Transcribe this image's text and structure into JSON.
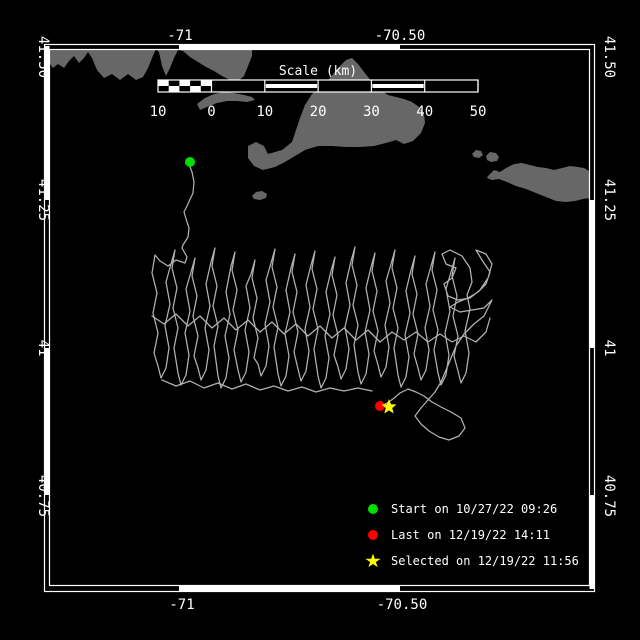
{
  "colors": {
    "background": "#000000",
    "frame": "#ffffff",
    "land": "#676767",
    "track": "#b2b2b2",
    "start": "#00e000",
    "last": "#ff0000",
    "selected": "#ffff00"
  },
  "axes": {
    "x_ticks": [
      {
        "label": "-71",
        "px": 180
      },
      {
        "label": "-70.50",
        "px": 400
      }
    ],
    "y_ticks": [
      {
        "label": "41.50",
        "py": 57
      },
      {
        "label": "41.25",
        "py": 200
      },
      {
        "label": "41",
        "py": 348
      },
      {
        "label": "40.75",
        "py": 496
      }
    ],
    "top_label_y": 40,
    "bottom_label_y": 609,
    "left_label_x": 39,
    "right_label_x": 605
  },
  "frame": {
    "outer": [
      44.5,
      44.5,
      594.5,
      591.5
    ],
    "inner": [
      49.5,
      49.5,
      589.5,
      585.5
    ],
    "solid_segments": {
      "top": [
        [
          179,
          400
        ]
      ],
      "bottom": [
        [
          179,
          400
        ]
      ],
      "left": [
        [
          46,
          200
        ],
        [
          348,
          495
        ]
      ],
      "right": [
        [
          200,
          348
        ],
        [
          495,
          589
        ]
      ]
    }
  },
  "scalebar": {
    "title": "Scale (km)",
    "title_px": 318,
    "title_py": 75,
    "x0": 158,
    "x1": 478,
    "y0": 80,
    "y1": 92,
    "zero_px": 211.5,
    "label_y": 116,
    "ticks": [
      {
        "label": "10",
        "px": 158
      },
      {
        "label": "0",
        "px": 211.5
      },
      {
        "label": "10",
        "px": 264.8
      },
      {
        "label": "20",
        "px": 318.1
      },
      {
        "label": "30",
        "px": 371.4
      },
      {
        "label": "40",
        "px": 424.7
      },
      {
        "label": "50",
        "px": 478
      }
    ],
    "striped_cells": [
      1,
      3
    ]
  },
  "legend": {
    "items": [
      {
        "marker": "circle",
        "color": "#00e000",
        "label": "Start on 10/27/22 09:26"
      },
      {
        "marker": "circle",
        "color": "#ff0000",
        "label": "Last on 12/19/22 14:11"
      },
      {
        "marker": "star",
        "color": "#ffff00",
        "label": "Selected on 12/19/22 11:56"
      }
    ]
  },
  "markers": [
    {
      "name": "start-marker",
      "type": "circle",
      "color": "#00e000",
      "x": 190,
      "y": 162,
      "r": 5
    },
    {
      "name": "last-marker",
      "type": "circle",
      "color": "#ff0000",
      "x": 380,
      "y": 406,
      "r": 5
    },
    {
      "name": "selected-marker",
      "type": "star",
      "color": "#ffff00",
      "x": 389,
      "y": 407,
      "r": 8
    }
  ],
  "land": [
    {
      "name": "mainland-coast",
      "points": [
        45,
        49,
        252,
        49,
        252,
        56,
        248,
        66,
        244,
        76,
        238,
        81,
        230,
        80,
        222,
        76,
        214,
        71,
        206,
        67,
        198,
        62,
        190,
        57,
        183,
        51,
        178,
        50,
        174,
        58,
        170,
        68,
        166,
        76,
        162,
        66,
        159,
        52,
        156,
        49,
        152,
        58,
        148,
        68,
        143,
        77,
        136,
        80,
        128,
        74,
        120,
        80,
        112,
        74,
        104,
        78,
        97,
        70,
        92,
        58,
        88,
        52,
        84,
        58,
        79,
        63,
        74,
        56,
        69,
        61,
        64,
        68,
        58,
        64,
        53,
        68,
        48,
        61,
        45,
        57
      ]
    },
    {
      "name": "elizabeth-islands",
      "points": [
        197,
        104,
        205,
        98,
        214,
        94,
        224,
        92,
        234,
        93,
        244,
        95,
        252,
        97,
        255,
        100,
        247,
        102,
        237,
        101,
        227,
        101,
        217,
        103,
        207,
        107,
        200,
        110
      ]
    },
    {
      "name": "marthas-vineyard",
      "points": [
        248,
        146,
        256,
        142,
        264,
        146,
        268,
        154,
        282,
        150,
        292,
        142,
        296,
        130,
        300,
        118,
        305,
        105,
        312,
        94,
        320,
        88,
        330,
        78,
        338,
        68,
        346,
        60,
        352,
        58,
        358,
        64,
        364,
        72,
        372,
        82,
        380,
        90,
        388,
        95,
        396,
        97,
        404,
        99,
        412,
        102,
        419,
        107,
        424,
        114,
        425,
        123,
        421,
        133,
        413,
        141,
        404,
        144,
        396,
        140,
        386,
        143,
        374,
        146,
        360,
        147,
        346,
        147,
        332,
        146,
        318,
        146,
        305,
        150,
        295,
        156,
        285,
        162,
        275,
        167,
        263,
        170,
        254,
        166,
        248,
        158
      ]
    },
    {
      "name": "nomans-land",
      "points": [
        252,
        196,
        256,
        192,
        262,
        191,
        267,
        194,
        266,
        198,
        260,
        200,
        254,
        199
      ]
    },
    {
      "name": "muskeget",
      "points": [
        472,
        154,
        476,
        150,
        481,
        151,
        483,
        155,
        479,
        158,
        474,
        157
      ]
    },
    {
      "name": "tuckernuck",
      "points": [
        486,
        156,
        490,
        152,
        496,
        153,
        499,
        157,
        497,
        161,
        491,
        162,
        487,
        160
      ]
    },
    {
      "name": "nantucket",
      "points": [
        488,
        176,
        494,
        170,
        500,
        172,
        506,
        168,
        514,
        164,
        522,
        163,
        530,
        165,
        538,
        167,
        546,
        168,
        554,
        170,
        562,
        168,
        570,
        166,
        578,
        167,
        584,
        168,
        589,
        171,
        589,
        198,
        583,
        199,
        575,
        201,
        566,
        202,
        556,
        201,
        546,
        197,
        536,
        193,
        526,
        189,
        516,
        186,
        507,
        182,
        499,
        179,
        492,
        180,
        487,
        178
      ]
    }
  ],
  "track": {
    "polylines": [
      [
        190,
        167,
        192,
        172,
        194,
        182,
        193,
        193,
        186,
        208,
        184,
        212,
        187,
        222,
        189,
        228,
        188,
        237,
        183,
        245,
        182,
        248,
        187,
        257,
        185,
        263,
        176,
        260,
        168,
        266,
        160,
        261,
        155,
        255,
        152,
        273,
        157,
        293,
        153,
        313,
        158,
        333,
        154,
        353,
        158,
        366,
        161,
        378,
        166,
        368,
        169,
        348,
        165,
        326,
        170,
        304,
        166,
        282,
        171,
        264,
        175,
        250,
        172,
        268,
        177,
        288,
        173,
        308,
        178,
        328,
        174,
        348,
        178,
        373,
        181,
        385,
        186,
        375,
        189,
        355,
        185,
        333,
        190,
        311,
        186,
        289,
        191,
        272,
        195,
        258,
        192,
        276,
        197,
        296,
        193,
        316,
        198,
        336,
        194,
        356,
        198,
        368,
        201,
        380,
        206,
        370,
        209,
        350,
        205,
        328,
        210,
        306,
        206,
        284,
        211,
        262,
        215,
        248,
        212,
        266,
        217,
        286,
        213,
        306,
        218,
        326,
        214,
        346,
        218,
        376,
        221,
        388,
        226,
        378,
        229,
        358,
        225,
        336,
        230,
        314,
        226,
        292,
        231,
        266,
        235,
        252,
        232,
        270,
        237,
        290,
        233,
        310,
        238,
        330,
        234,
        350,
        238,
        370,
        241,
        382,
        246,
        372,
        249,
        352,
        245,
        330,
        250,
        308,
        246,
        286,
        251,
        274,
        255,
        260,
        252,
        278,
        257,
        298,
        253,
        318,
        258,
        338,
        254,
        358,
        258,
        364,
        261,
        376,
        266,
        366,
        269,
        346,
        265,
        324,
        270,
        302,
        266,
        280,
        271,
        263,
        275,
        249,
        272,
        267,
        277,
        287,
        273,
        307,
        278,
        327,
        274,
        347,
        278,
        374,
        281,
        386,
        286,
        376,
        289,
        356,
        285,
        334,
        290,
        312,
        286,
        290,
        291,
        268,
        295,
        254,
        292,
        272,
        297,
        292,
        293,
        312,
        298,
        332,
        294,
        352,
        298,
        369,
        301,
        381,
        306,
        371,
        309,
        351,
        305,
        329,
        310,
        307,
        306,
        285,
        311,
        265,
        315,
        251,
        312,
        269,
        317,
        289,
        313,
        309,
        318,
        329,
        314,
        349,
        318,
        376,
        321,
        388,
        326,
        378,
        329,
        358,
        325,
        336,
        330,
        314,
        326,
        292,
        331,
        271,
        335,
        257,
        332,
        275,
        337,
        295,
        333,
        315,
        338,
        335,
        334,
        355,
        338,
        367,
        341,
        379,
        346,
        369,
        349,
        349,
        345,
        327,
        350,
        305,
        346,
        283,
        351,
        261,
        355,
        247,
        352,
        265,
        357,
        285,
        353,
        305,
        358,
        325,
        354,
        345,
        358,
        372,
        361,
        384,
        366,
        374,
        369,
        354,
        365,
        332,
        370,
        310,
        366,
        288,
        371,
        267,
        375,
        253,
        372,
        271,
        377,
        291,
        373,
        311,
        378,
        331,
        374,
        351,
        378,
        365,
        381,
        377,
        386,
        367,
        389,
        347,
        385,
        325,
        390,
        303,
        386,
        281,
        391,
        264,
        395,
        250,
        392,
        268,
        397,
        288,
        393,
        308,
        398,
        328,
        394,
        348,
        398,
        375,
        401,
        387,
        406,
        377,
        409,
        357,
        405,
        335,
        410,
        313,
        406,
        291,
        411,
        270,
        415,
        256,
        412,
        274,
        417,
        294,
        413,
        314,
        418,
        334,
        414,
        354,
        418,
        368,
        421,
        380,
        426,
        370,
        429,
        350,
        425,
        328,
        430,
        306,
        426,
        284,
        431,
        266,
        435,
        252,
        432,
        270,
        437,
        290,
        433,
        310,
        438,
        330,
        434,
        350,
        438,
        373,
        441,
        385,
        446,
        375,
        449,
        355,
        445,
        333,
        450,
        311,
        446,
        289,
        451,
        272,
        455,
        258,
        452,
        276,
        457,
        296,
        453,
        316,
        458,
        336,
        454,
        356,
        458,
        371,
        461,
        383,
        466,
        373,
        469,
        353,
        465,
        331,
        470,
        309,
        467,
        295,
        472,
        282,
        470,
        268,
        462,
        256,
        450,
        250,
        442,
        254,
        446,
        264,
        456,
        268,
        452,
        278,
        444,
        284,
        448,
        296,
        458,
        300,
        470,
        298,
        480,
        290,
        488,
        278,
        492,
        264,
        486,
        254,
        476,
        250,
        482,
        260,
        490,
        272,
        486,
        284,
        478,
        292,
        468,
        298,
        458,
        302,
        450,
        307,
        460,
        312,
        472,
        310,
        484,
        308,
        492,
        300,
        484,
        316,
        474,
        324,
        464,
        334,
        456,
        346,
        451,
        358,
        446,
        370,
        441,
        382,
        435,
        392,
        428,
        400,
        421,
        408,
        415,
        416,
        421,
        424,
        429,
        431,
        439,
        437,
        449,
        440,
        459,
        436,
        465,
        428,
        461,
        418,
        451,
        412,
        441,
        407,
        432,
        402,
        424,
        396,
        416,
        392,
        408,
        389,
        400,
        393,
        393,
        399,
        387,
        403,
        381,
        406
      ],
      [
        152,
        316,
        164,
        324,
        176,
        314,
        188,
        326,
        200,
        316,
        212,
        328,
        224,
        318,
        236,
        330,
        248,
        320,
        260,
        332,
        272,
        322,
        284,
        334,
        296,
        324,
        308,
        336,
        320,
        326,
        332,
        338,
        344,
        328,
        356,
        340,
        368,
        330,
        380,
        342,
        392,
        332,
        404,
        340,
        416,
        332,
        428,
        342,
        440,
        334,
        452,
        342,
        464,
        336,
        476,
        342,
        486,
        332,
        490,
        318
      ],
      [
        162,
        380,
        176,
        386,
        190,
        381,
        204,
        388,
        218,
        383,
        232,
        389,
        246,
        384,
        260,
        390,
        274,
        386,
        288,
        391,
        302,
        387,
        316,
        392,
        330,
        388,
        344,
        391,
        358,
        388,
        372,
        391
      ]
    ]
  }
}
